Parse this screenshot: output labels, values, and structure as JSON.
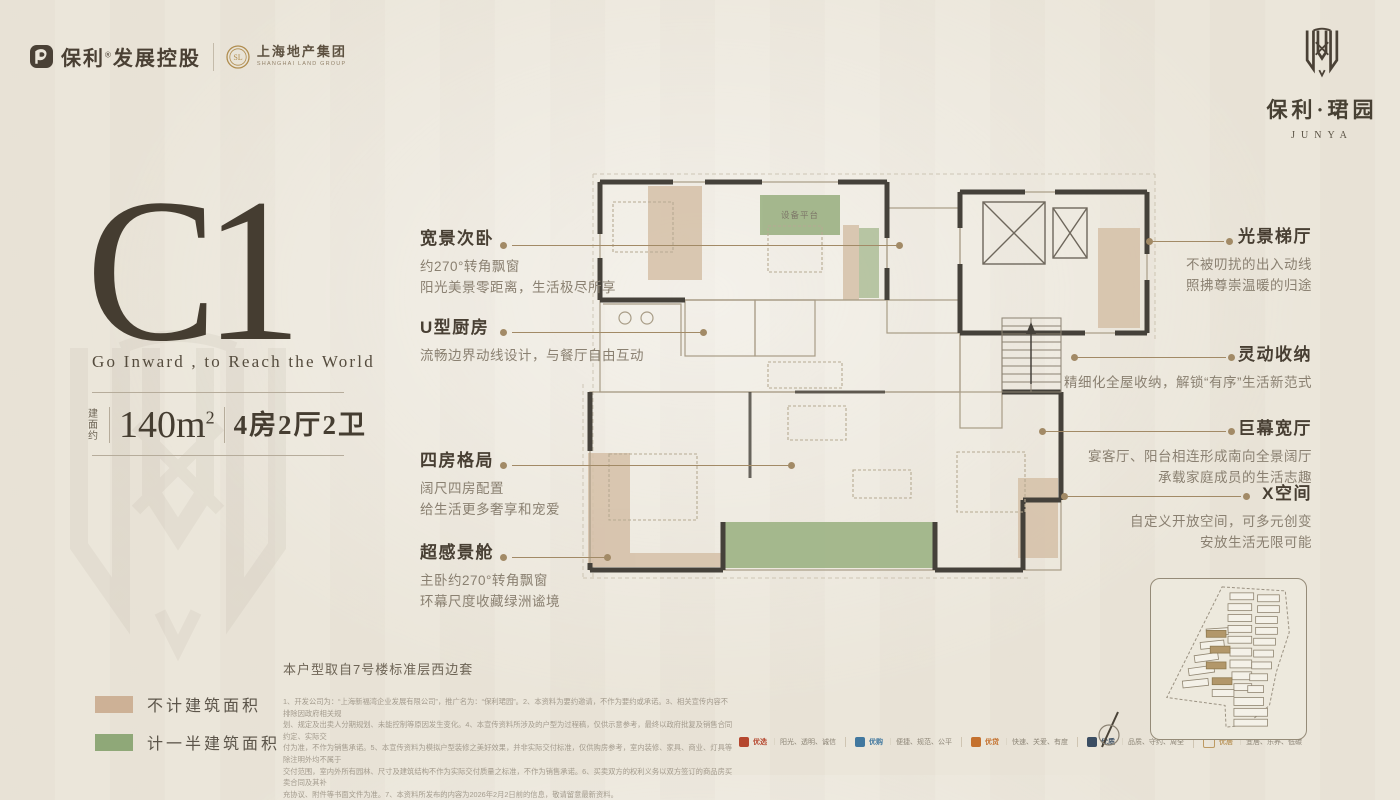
{
  "header": {
    "poly_name": "保利",
    "poly_reg": "®",
    "poly_suffix": "发展控股",
    "partner_cn": "上海地产集团",
    "partner_en": "SHANGHAI LAND GROUP",
    "partner_monogram": "SL",
    "project_cn": "保利·珺园",
    "project_en": "JUNYA"
  },
  "hero": {
    "unit_code": "C1",
    "tagline": "Go Inward , to Reach the World",
    "area_label": "建面约",
    "area_value": "140m",
    "area_sup": "2",
    "rooms": "4房2厅2卫"
  },
  "callouts_left": [
    {
      "title": "宽景次卧",
      "lines": [
        "约270°转角飘窗",
        "阳光美景零距离，生活极尽所享"
      ]
    },
    {
      "title": "U型厨房",
      "lines": [
        "流畅边界动线设计，与餐厅自由互动"
      ]
    },
    {
      "title": "四房格局",
      "lines": [
        "阔尺四房配置",
        "给生活更多奢享和宠爱"
      ]
    },
    {
      "title": "超感景舱",
      "lines": [
        "主卧约270°转角飘窗",
        "环幕尺度收藏绿洲谧境"
      ]
    }
  ],
  "callouts_right": [
    {
      "title": "光景梯厅",
      "lines": [
        "不被叨扰的出入动线",
        "照拂尊崇温暖的归途"
      ]
    },
    {
      "title": "灵动收纳",
      "lines": [
        "精细化全屋收纳，解锁“有序”生活新范式"
      ]
    },
    {
      "title": "巨幕宽厅",
      "lines": [
        "宴客厅、阳台相连形成南向全景阔厅",
        "承载家庭成员的生活志趣"
      ]
    },
    {
      "title": "X空间",
      "lines": [
        "自定义开放空间，可多元创变",
        "安放生活无限可能"
      ]
    }
  ],
  "plan": {
    "platform_label": "设备平台"
  },
  "legend": {
    "items": [
      {
        "color": "#cdb196",
        "label": "不计建筑面积"
      },
      {
        "color": "#8fa878",
        "label": "计一半建筑面积"
      }
    ]
  },
  "footnote": "本户型取自7号楼标准层西边套",
  "disclaimer": {
    "lines": [
      "1、开发公司为：“上海新福湾企业发展有限公司”，推广名为：“保利珺园”。2、本资料为要约邀请，不作为要约或承诺。3、相关宣传内容不排除因政府相关规",
      "划、规定及出卖人分期规划、未能控制等原因发生变化。4、本宣传资料所涉及的户型为过程稿，仅供示意参考，最终以政府批复及销售合同约定、实际交",
      "付为准，不作为销售承诺。5、本宣传资料为模拟户型装修之美好效果，并非实际交付标准，仅供购房参考，室内装修、家具、商业、灯具等除注明外均不属于",
      "交付范围，室内外所有园林、尺寸及建筑结构不作为实际交付质量之标准，不作为销售承诺。6、买卖双方的权利义务以双方签订的商品房买卖合同及其补",
      "充协议、附件等书面文件为准。7、本资料所发布的内容为2026年2月2日前的信息，敬请留意最新资料。"
    ]
  },
  "badges": [
    {
      "name": "优选",
      "desc": "阳光、透明、诚信",
      "color": "#b5472e"
    },
    {
      "name": "优购",
      "desc": "便捷、规范、公平",
      "color": "#41789f"
    },
    {
      "name": "优贷",
      "desc": "快速、关爱、有度",
      "color": "#c4712e"
    },
    {
      "name": "优质",
      "desc": "品质、守约、周全",
      "color": "#3b4e63"
    },
    {
      "name": "优居",
      "desc": "宜居、乐养、低碳",
      "color": "#bd9a63"
    }
  ]
}
